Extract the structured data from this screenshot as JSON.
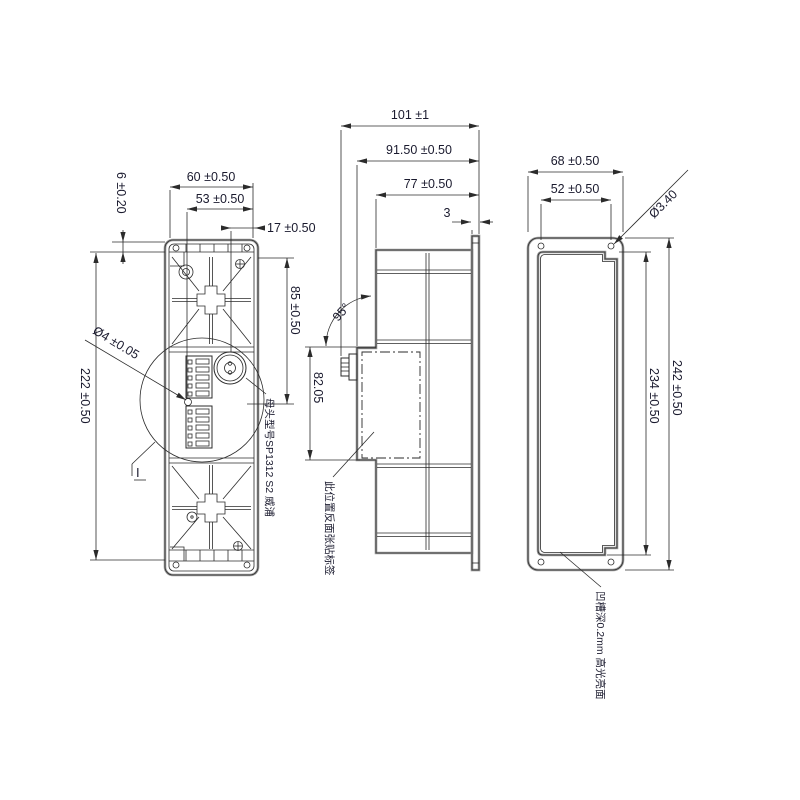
{
  "drawing": {
    "title": "connector-panel-3-view-technical-drawing",
    "colors": {
      "background": "#ffffff",
      "line": "#2b2b2b",
      "outline": "#9a9a9a",
      "text": "#1a1a2e"
    },
    "views": {
      "left": {
        "dims": {
          "d60": "60 ±0.50",
          "d53": "53 ±0.50",
          "d17": "17 ±0.50",
          "d6": "6 ±0.20",
          "d222": "222 ±0.50",
          "d85": "85 ±0.50",
          "d4": "Ø4 ±0.05",
          "detail_label": "I"
        },
        "note": "母头型号SP1312 S2 威浦"
      },
      "middle": {
        "dims": {
          "d101": "101 ±1",
          "d91": "91.50 ±0.50",
          "d77": "77 ±0.50",
          "d3": "3",
          "angle": "95°",
          "d82": "82.05"
        },
        "note": "此位置反面张贴标签"
      },
      "right": {
        "dims": {
          "d68": "68 ±0.50",
          "d52": "52 ±0.50",
          "d340": "Ø3.40",
          "d242": "242 ±0.50",
          "d234": "234 ±0.50"
        },
        "note": "凹槽深0.2mm 高光亮面"
      }
    }
  }
}
